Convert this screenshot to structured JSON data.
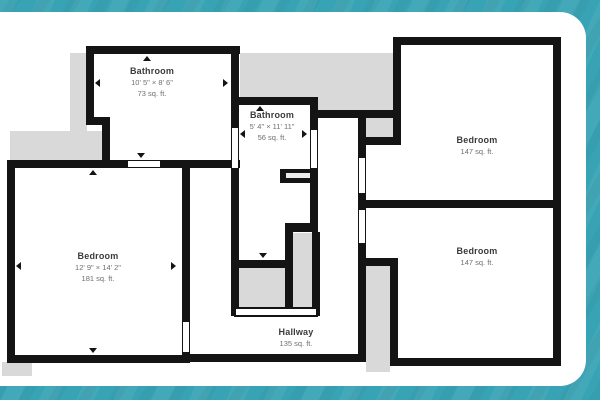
{
  "frame": {
    "background_color": "#38a3b4",
    "card_color": "#ffffff"
  },
  "floor_plan": {
    "wall_color": "#141414",
    "backing_color": "#d9d9d9",
    "rooms": [
      {
        "name": "Bathroom",
        "dimensions": "10' 5\" × 8' 6\"",
        "area": "73 sq. ft."
      },
      {
        "name": "Bathroom",
        "dimensions": "5' 4\" × 11' 11\"",
        "area": "56 sq. ft."
      },
      {
        "name": "Bedroom",
        "area": "147 sq. ft."
      },
      {
        "name": "Bedroom",
        "area": "147 sq. ft."
      },
      {
        "name": "Bedroom",
        "dimensions": "12' 9\" × 14' 2\"",
        "area": "181 sq. ft."
      },
      {
        "name": "Hallway",
        "area": "135 sq. ft."
      }
    ]
  }
}
